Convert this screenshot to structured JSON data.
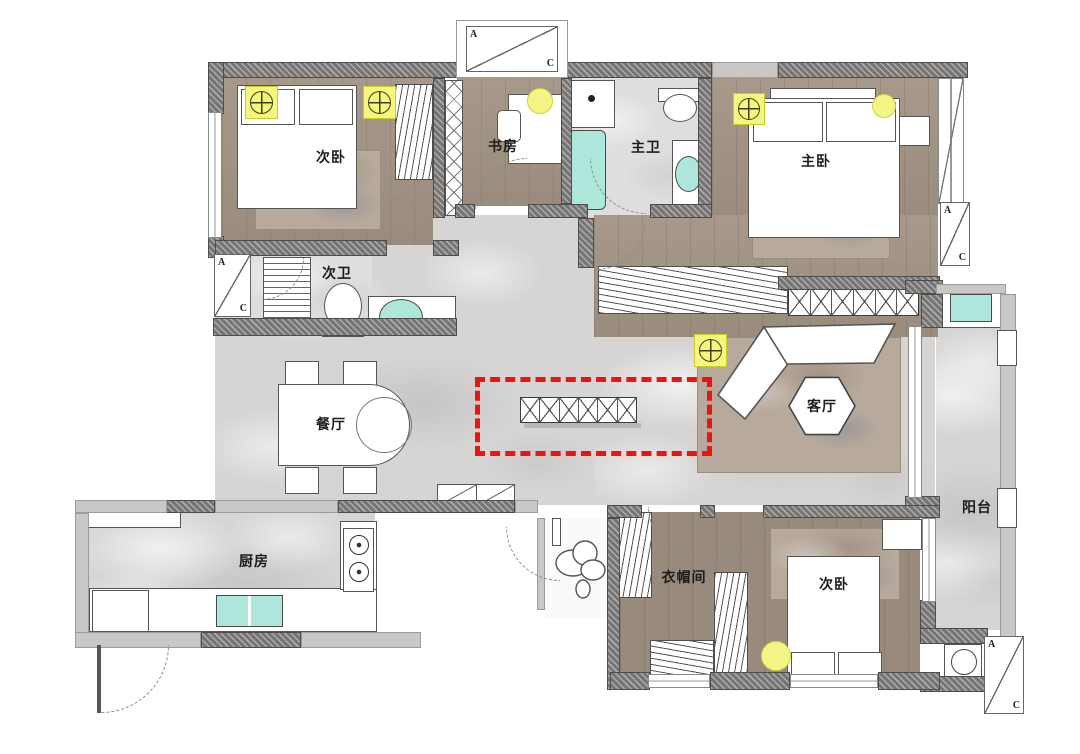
{
  "plan": {
    "type": "apartment-floor-plan",
    "rooms": {
      "bedroom_nw": "次卧",
      "study": "书房",
      "master_bath": "主卫",
      "master_bedroom": "主卧",
      "second_bath": "次卫",
      "dining": "餐厅",
      "living": "客厅",
      "kitchen": "厨房",
      "cloakroom": "衣帽间",
      "bedroom_se": "次卧",
      "balcony": "阳台"
    },
    "ac": {
      "letter_a": "A",
      "letter_c": "C"
    },
    "highlight": {
      "color": "#e81510",
      "style": "dashed-rectangle"
    },
    "colors": {
      "wall": "#767574",
      "wood_floor": "#a29384",
      "marble_floor": "#d6d5d3",
      "fixture_teal": "#ade7db",
      "light_yellow": "#f5f67c",
      "furniture": "#ffffff"
    }
  }
}
